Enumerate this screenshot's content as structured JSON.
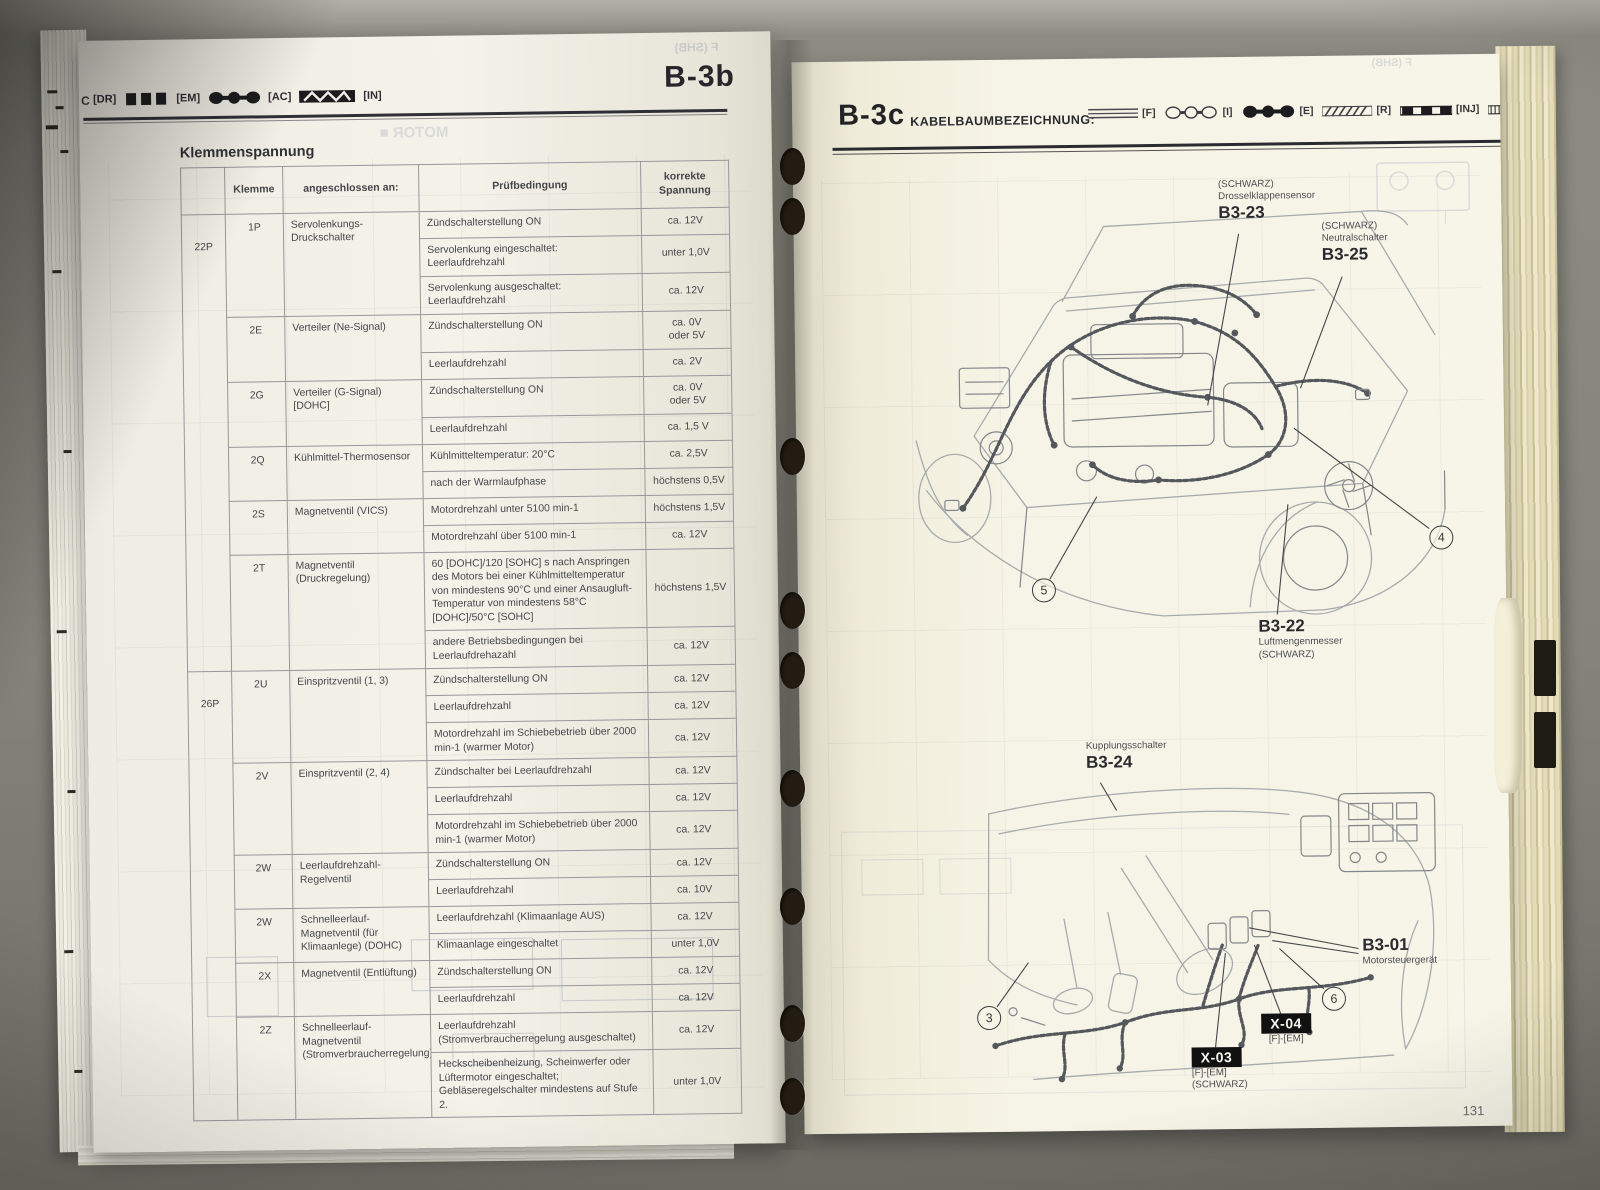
{
  "left_page": {
    "header": {
      "page_id": "B-3b",
      "corner": "C"
    },
    "legend": [
      {
        "label": "[DR]",
        "icon": "beam-bars-icon"
      },
      {
        "label": "[EM]",
        "icon": "filled-ovals-icon"
      },
      {
        "label": "[AC]",
        "icon": "zigzag-band-icon"
      },
      {
        "label": "[IN]",
        "icon": ""
      }
    ],
    "title": "Klemmenspannung",
    "bleed": {
      "top": "F (SHB)",
      "word": "MOTOR ■"
    },
    "table": {
      "headers": [
        "",
        "Klemme",
        "angeschlossen an:",
        "Prüfbedingung",
        "korrekte Spannung"
      ],
      "rows": [
        {
          "group": "22P",
          "group_span": 13,
          "klemme": "1P",
          "span": 3,
          "connected": "Servolenkungs-Druckschalter",
          "condition": "Zündschalterstellung ON",
          "voltage": "ca. 12V"
        },
        {
          "condition": "Servolenkung eingeschaltet: Leerlaufdrehzahl",
          "voltage": "unter 1,0V"
        },
        {
          "condition": "Servolenkung ausgeschaltet: Leerlaufdrehzahl",
          "voltage": "ca. 12V"
        },
        {
          "klemme": "2E",
          "span": 2,
          "connected": "Verteiler (Ne-Signal)",
          "condition": "Zündschalterstellung ON",
          "voltage": "ca. 0V\noder 5V"
        },
        {
          "condition": "Leerlaufdrehzahl",
          "voltage": "ca. 2V"
        },
        {
          "klemme": "2G",
          "span": 2,
          "connected": "Verteiler (G-Signal) [DOHC]",
          "condition": "Zündschalterstellung ON",
          "voltage": "ca. 0V\noder 5V"
        },
        {
          "condition": "Leerlaufdrehzahl",
          "voltage": "ca. 1,5 V"
        },
        {
          "klemme": "2Q",
          "span": 2,
          "connected": "Kühlmittel-Thermosensor",
          "condition": "Kühlmitteltemperatur: 20°C",
          "voltage": "ca. 2,5V"
        },
        {
          "condition": "nach der Warmlaufphase",
          "voltage": "höchstens 0,5V"
        },
        {
          "klemme": "2S",
          "span": 2,
          "connected": "Magnetventil (VICS)",
          "condition": "Motordrehzahl unter 5100 min-1",
          "voltage": "höchstens 1,5V"
        },
        {
          "condition": "Motordrehzahl über 5100 min-1",
          "voltage": "ca. 12V"
        },
        {
          "klemme": "2T",
          "span": 2,
          "connected": "Magnetventil (Druckregelung)",
          "condition": "60 [DOHC]/120 [SOHC] s nach Anspringen des Motors bei einer Kühlmitteltemperatur von mindestens 90°C und einer Ansaugluft-Temperatur von mindestens 58°C [DOHC]/50°C [SOHC]",
          "voltage": "höchstens 1,5V"
        },
        {
          "condition": "andere Betriebsbedingungen bei Leerlaufdrehazahl",
          "voltage": "ca. 12V"
        },
        {
          "group": "26P",
          "group_span": 14,
          "klemme": "2U",
          "span": 3,
          "connected": "Einspritzventil (1, 3)",
          "condition": "Zündschalterstellung ON",
          "voltage": "ca. 12V"
        },
        {
          "condition": "Leerlaufdrehzahl",
          "voltage": "ca. 12V"
        },
        {
          "condition": "Motordrehzahl im Schiebebetrieb über 2000 min-1 (warmer Motor)",
          "voltage": "ca. 12V"
        },
        {
          "klemme": "2V",
          "span": 3,
          "connected": "Einspritzventil (2, 4)",
          "condition": "Zündschalter bei Leerlaufdrehzahl",
          "voltage": "ca. 12V"
        },
        {
          "condition": "Leerlaufdrehzahl",
          "voltage": "ca. 12V"
        },
        {
          "condition": "Motordrehzahl im Schiebebetrieb über 2000 min-1 (warmer Motor)",
          "voltage": "ca. 12V"
        },
        {
          "klemme": "2W",
          "span": 2,
          "connected": "Leerlaufdrehzahl-Regelventil",
          "condition": "Zündschalterstellung ON",
          "voltage": "ca. 12V"
        },
        {
          "condition": "Leerlaufdrehzahl",
          "voltage": "ca. 10V"
        },
        {
          "klemme": "2W",
          "span": 2,
          "connected": "Schnelleerlauf-Magnetventil (für Klimaanlege) (DOHC)",
          "condition": "Leerlaufdrehzahl (Klimaanlage AUS)",
          "voltage": "ca. 12V"
        },
        {
          "condition": "Klimaanlage eingeschaltet",
          "voltage": "unter 1,0V"
        },
        {
          "klemme": "2X",
          "span": 2,
          "connected": "Magnetventil (Entlüftung)",
          "condition": "Zündschalterstellung ON",
          "voltage": "ca. 12V"
        },
        {
          "condition": "Leerlaufdrehzahl",
          "voltage": "ca. 12V"
        },
        {
          "klemme": "2Z",
          "span": 2,
          "connected": "Schnelleerlauf-Magnetventil (Stromverbraucherregelung)",
          "condition": "Leerlaufdrehzahl (Stromverbraucherregelung ausgeschaltet)",
          "voltage": "ca. 12V"
        },
        {
          "condition": "Heckscheibenheizung, Scheinwerfer oder Lüftermotor eingeschaltet; Gebläseregelschalter mindestens auf Stufe 2.",
          "voltage": "unter 1,0V"
        }
      ]
    }
  },
  "right_page": {
    "header": {
      "page_id": "B-3c",
      "title": "KABELBAUMBEZEICHNUNG:"
    },
    "legend": [
      {
        "label": "[F]",
        "swatch": "plain-lines-icon"
      },
      {
        "label": "[I]",
        "swatch": "outline-ovals-icon"
      },
      {
        "label": "[E]",
        "swatch": "filled-ovals-icon"
      },
      {
        "label": "[R]",
        "swatch": "hatched-band-icon"
      },
      {
        "label": "[INJ]",
        "swatch": "black-blocks-icon"
      }
    ],
    "bleed": {
      "top": "F (SHB)"
    },
    "labels": {
      "b3_23": {
        "note": "(SCHWARZ)",
        "name": "Drosselklappensensor",
        "code": "B3-23"
      },
      "b3_25": {
        "note": "(SCHWARZ)",
        "name": "Neutralschalter",
        "code": "B3-25"
      },
      "b3_22": {
        "code": "B3-22",
        "name": "Luftmengenmesser",
        "note": "(SCHWARZ)"
      },
      "b3_24": {
        "name": "Kupplungsschalter",
        "code": "B3-24"
      },
      "b3_01": {
        "code": "B3-01",
        "name": "Motorsteuergerät"
      },
      "x04": {
        "code": "X-04",
        "sub": "[F]-[EM]"
      },
      "x03": {
        "code": "X-03",
        "sub": "[F]-[EM]",
        "note": "(SCHWARZ)"
      }
    },
    "callouts": {
      "c3": "3",
      "c4": "4",
      "c5": "5",
      "c6": "6"
    },
    "page_number": "131"
  }
}
